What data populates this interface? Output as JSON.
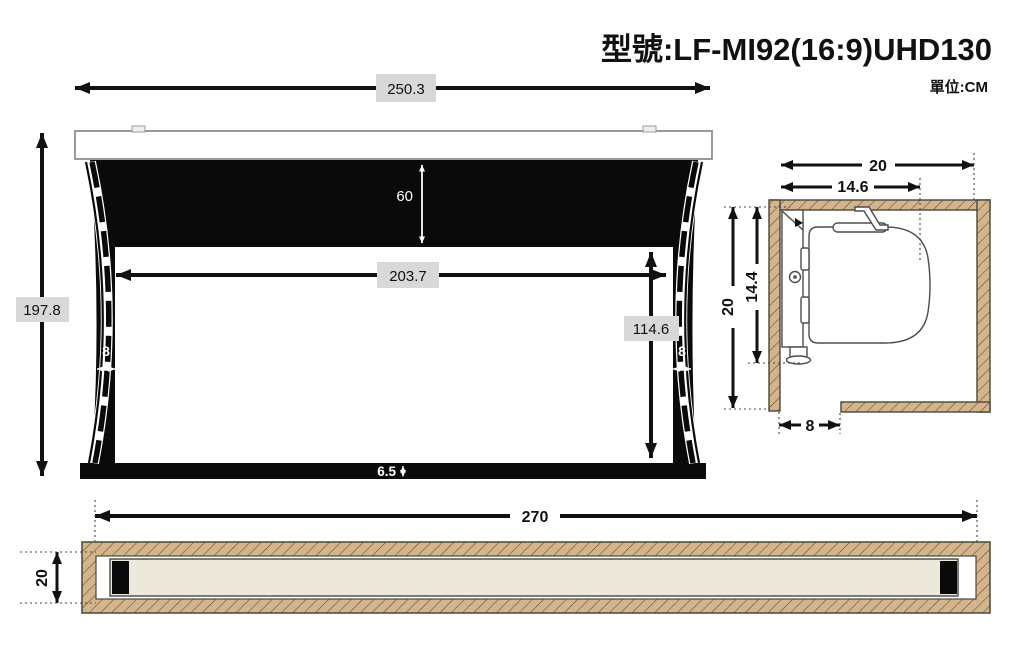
{
  "title": "型號:LF-MI92(16:9)UHD130",
  "unit_label": "單位:CM",
  "front_view": {
    "dims": {
      "total_width": "250.3",
      "total_height": "197.8",
      "black_drop": "60",
      "viewing_width": "203.7",
      "viewing_height": "114.6",
      "left_border": "8",
      "right_border": "8",
      "bottom_bar_height": "6.5"
    }
  },
  "side_view": {
    "dims": {
      "recess_width": "20",
      "device_width": "14.6",
      "recess_height": "20",
      "device_height": "14.4",
      "opening_width": "8"
    }
  },
  "bottom_view": {
    "dims": {
      "recess_length": "270",
      "recess_depth": "20"
    }
  },
  "colors": {
    "label_bg": "#d8d8d8",
    "hatch_fill": "#d4b48d",
    "casing_fill": "#ece9dc"
  }
}
